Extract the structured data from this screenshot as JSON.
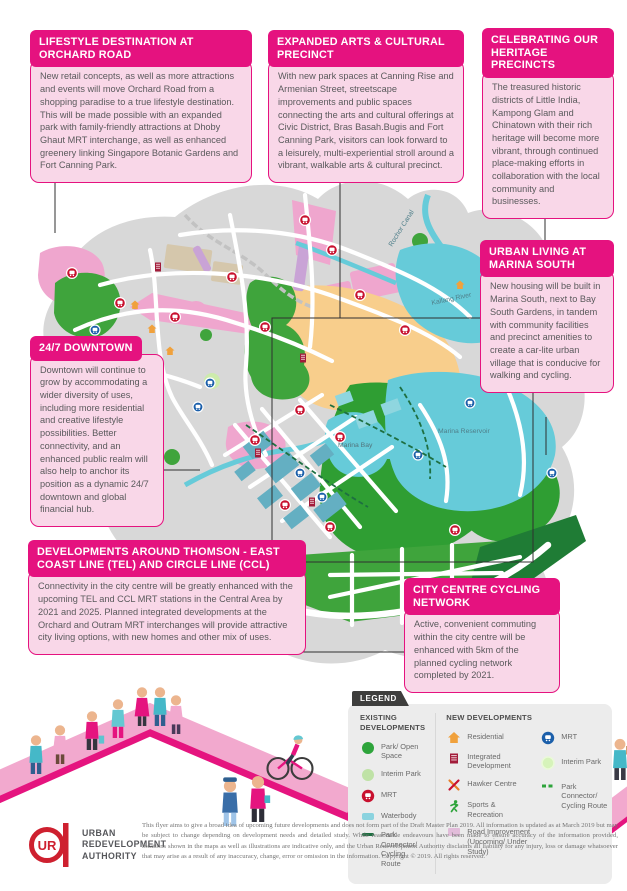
{
  "colors": {
    "accent_magenta": "#E5127F",
    "callout_body_pink": "#F9D7E8",
    "legend_bg": "#ECECEC",
    "map_land_gray": "#D8D8D8",
    "water_teal": "#66CBD9",
    "park_green": "#35A13B",
    "mrt_red": "#C8102E",
    "mrt_blue": "#1B5FAA",
    "logo_red": "#CE202F"
  },
  "callouts": {
    "orchard": {
      "title": "LIFESTYLE DESTINATION AT ORCHARD ROAD",
      "body": "New retail concepts, as well as more attractions and events will move Orchard Road from a shopping paradise to a true lifestyle destination. This will be made possible with an expanded park with family-friendly attractions at Dhoby Ghaut MRT interchange, as well as enhanced greenery linking Singapore Botanic Gardens and Fort Canning Park."
    },
    "arts": {
      "title": "EXPANDED ARTS & CULTURAL PRECINCT",
      "body": "With new park spaces at Canning Rise and Armenian Street, streetscape improvements and public spaces connecting the arts and cultural offerings at Civic District, Bras Basah.Bugis and Fort Canning Park, visitors can look forward to a leisurely, multi-experiential stroll around a vibrant, walkable arts & cultural precinct."
    },
    "heritage": {
      "title": "CELEBRATING OUR HERITAGE PRECINCTS",
      "body": "The treasured historic districts of Little India, Kampong Glam and Chinatown with their rich heritage will become more vibrant, through continued place-making efforts in collaboration with the local community and businesses."
    },
    "marina_south": {
      "title": "URBAN LIVING AT MARINA SOUTH",
      "body": "New housing will be built in Marina South, next to Bay South Gardens, in tandem with community facilities and precinct amenities to create a car-lite urban village that is conducive for walking and cycling."
    },
    "downtown": {
      "title": "24/7 DOWNTOWN",
      "body": "Downtown will continue to grow by accommodating a wider diversity of uses, including more residential and creative lifestyle possibilities. Better connectivity, and an enhanced public realm will also help to anchor its position as a dynamic 24/7 downtown and global financial hub."
    },
    "tel_ccl": {
      "title": "DEVELOPMENTS AROUND THOMSON - EAST COAST LINE (TEL) AND CIRCLE LINE (CCL)",
      "body": "Connectivity in the city centre will be greatly enhanced with the upcoming TEL and CCL MRT stations in the Central Area by 2021 and 2025. Planned integrated developments at the Orchard and Outram MRT interchanges will provide attractive city living options, with new homes and other mix of uses."
    },
    "cycling": {
      "title": "CITY CENTRE CYCLING NETWORK",
      "body": "Active, convenient commuting within the city centre will be enhanced with 5km of the planned cycling network completed by 2021."
    }
  },
  "map": {
    "labels": {
      "rochor": "Rochor Canal",
      "kallang": "Kallang River",
      "reservoir": "Marina Reservoir",
      "bay": "Marina Bay"
    }
  },
  "legend": {
    "title": "LEGEND",
    "existing": {
      "heading": "EXISTING DEVELOPMENTS",
      "items": [
        {
          "icon": "park-open-space-icon",
          "label": "Park/ Open Space"
        },
        {
          "icon": "interim-park-icon",
          "label": "Interim Park"
        },
        {
          "icon": "mrt-existing-icon",
          "label": "MRT"
        },
        {
          "icon": "waterbody-icon",
          "label": "Waterbody"
        },
        {
          "icon": "park-connector-icon",
          "label": "Park Connector/ Cycling Route"
        }
      ]
    },
    "newdev": {
      "heading": "NEW DEVELOPMENTS",
      "col_a": [
        {
          "icon": "residential-icon",
          "label": "Residential"
        },
        {
          "icon": "integrated-development-icon",
          "label": "Integrated Development"
        },
        {
          "icon": "hawker-centre-icon",
          "label": "Hawker Centre"
        },
        {
          "icon": "sports-recreation-icon",
          "label": "Sports & Recreation"
        },
        {
          "icon": "road-improvement-icon",
          "label": "Road Improvement (Upcoming/ Under Study)"
        }
      ],
      "col_b": [
        {
          "icon": "mrt-new-icon",
          "label": "MRT"
        },
        {
          "icon": "interim-park-new-icon",
          "label": "Interim Park"
        },
        {
          "icon": "cycling-route-new-icon",
          "label": "Park Connector/ Cycling Route"
        }
      ]
    }
  },
  "footer": {
    "logo_line1": "URBAN",
    "logo_line2": "REDEVELOPMENT",
    "logo_line3": "AUTHORITY",
    "disclaimer": "This flyer aims to give a broad idea of upcoming future developments and does not form part of the Draft Master Plan 2019. All information is updated as at March 2019 but may be subject to change depending on development needs and detailed study. While reasonable endeavours have been made to ensure accuracy of the information provided, locations shown in the maps as well as illustrations are indicative only, and the Urban Redevelopment Authority disclaims all liability for any injury, loss or damage whatsoever that may arise as a result of any inaccuracy, change, error or omission in the information. Copyright © 2019. All rights reserved."
  }
}
